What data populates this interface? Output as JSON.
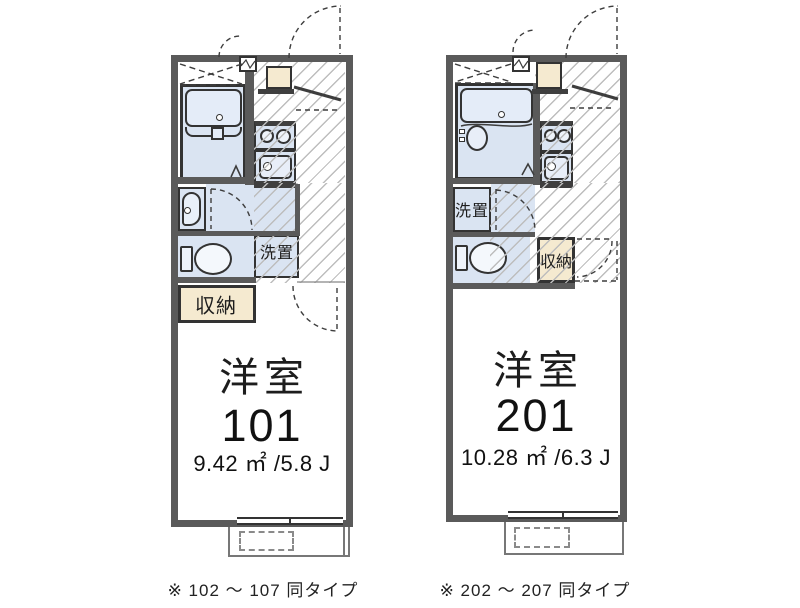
{
  "title": "apartment-floorplans",
  "colors": {
    "wall": "#5a5a5a",
    "floor_blue": "#dae4f2",
    "tub_fill": "#e4ecf8",
    "storage_beige": "#f5ead0",
    "hatch_line": "#bdbdbd"
  },
  "plans": [
    {
      "unit": "101",
      "room_type": "洋室",
      "area": "9.42 ㎡ /5.8 J",
      "caption": "※ 102 〜 107 同タイプ",
      "labels": {
        "washer": "洗置",
        "storage": "収納"
      }
    },
    {
      "unit": "201",
      "room_type": "洋室",
      "area": "10.28 ㎡ /6.3 J",
      "caption": "※ 202 〜 207 同タイプ",
      "labels": {
        "washer": "洗置",
        "storage": "収納"
      }
    }
  ]
}
